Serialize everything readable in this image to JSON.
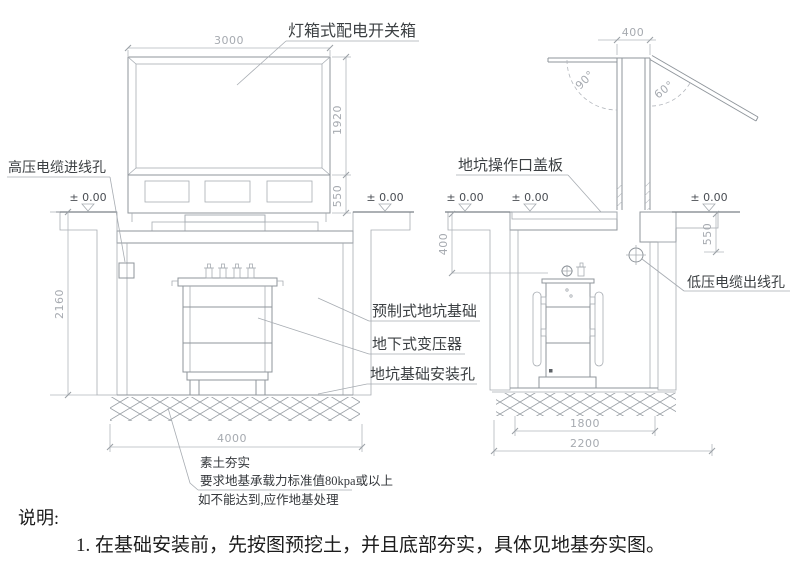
{
  "notes": {
    "heading": "说明:",
    "item1": "1. 在基础安装前，先按图预挖土，并且底部夯实，具体见地基夯实图。"
  },
  "front_view": {
    "label_switch_box": "灯箱式配电开关箱",
    "label_hv_cable_hole": "高压电缆进线孔",
    "label_precast_pit": "预制式地坑基础",
    "label_underground_transformer": "地下式变压器",
    "label_pit_mount_hole": "地坑基础安装孔",
    "level_left": "± 0.00",
    "level_right": "± 0.00",
    "dim_top_width": "3000",
    "dim_box_height": "1920",
    "dim_base_height": "550",
    "dim_pit_depth": "2160",
    "dim_pit_width": "4000"
  },
  "side_view": {
    "label_cover_plate": "地坑操作口盖板",
    "label_lv_cable_hole": "低压电缆出线孔",
    "level_left": "± 0.00",
    "level_mid": "± 0.00",
    "level_right": "± 0.00",
    "dim_shaft_width": "400",
    "angle_open": "90°",
    "angle_lid": "60°",
    "dim_depth_400": "400",
    "dim_depth_550": "550",
    "dim_inner_width": "1800",
    "dim_outer_width": "2200"
  },
  "ground_notes": {
    "line1": "素土夯实",
    "line2": "要求地基承载力标准值80kpa或以上",
    "line3": "如不能达到,应作地基处理"
  }
}
